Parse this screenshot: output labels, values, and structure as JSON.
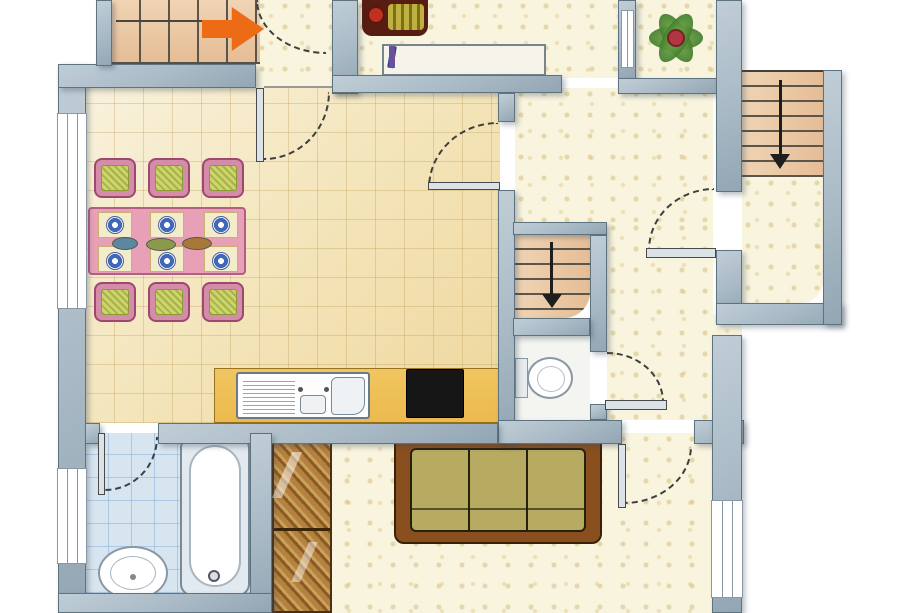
{
  "document": {
    "type": "floor-plan",
    "title": "apartment-floor-plan",
    "visible_text": ""
  },
  "colors": {
    "wall": "#a9bac6",
    "wall_hi": "#c0cdd6",
    "wall_edge": "#5d7380",
    "tile_a": "#f8f1dc",
    "tile_b": "#eed79c",
    "tile_line": "rgba(187,150,80,0.32)",
    "speckle_bg": "#f8f4de",
    "bath": "#d7e5f0",
    "wc": "#f4f5f1",
    "tread": "#e7c29c",
    "tread_line": "#5a564c",
    "arrow_up": "#ed6b15",
    "arrow_down": "#1e1e1e",
    "counter": "#ecba4e",
    "counter_edge": "#9a7320",
    "stove": "#161616",
    "table": "#e8a0b6",
    "table_edge": "#b25f84",
    "chair_frame": "#d58ca9",
    "chair_edge": "#9c4870",
    "chair_seat": "#ccd46a",
    "chair_seat_edge": "#8a9a34",
    "mat": "#f3ecca",
    "plate": "#3f68b8",
    "dish_teal": "#5b87a0",
    "dish_olive": "#8a9a4a",
    "dish_brown": "#a87838",
    "sofa_frame": "#8a4f1e",
    "sofa_edge": "#3a2008",
    "sofa_seat": "#b7ab61",
    "wardrobe_a": "#b5813f",
    "wardrobe_b": "#8a5a24",
    "wardrobe_c": "#caa05a",
    "wardrobe_edge": "#4a3010",
    "fixture": "#ffffff",
    "fixture_edge": "#8a98a5",
    "door_arc": "#3f3f3f",
    "door_leaf": "#dce3e8",
    "door_leaf_edge": "#4a4a4a",
    "bookshelf_bg": "#f6f4ea",
    "bookshelf_edge": "#77858c",
    "plant_green": "#3e7a2a",
    "plant_light": "#7ab24e",
    "plant_flower": "#b23642",
    "decor_base": "#571c12",
    "decor_stripe": "#c0b040",
    "decor_red": "#c03020",
    "window": "#ffffff",
    "window_edge": "#8a98a5"
  },
  "rooms": [
    {
      "name": "entry-hall",
      "floor": "speckled"
    },
    {
      "name": "dining-kitchen",
      "floor": "tiled"
    },
    {
      "name": "hallway",
      "floor": "speckled"
    },
    {
      "name": "bookshelf-alcove",
      "floor": "speckled"
    },
    {
      "name": "plant-room",
      "floor": "speckled"
    },
    {
      "name": "stair-room-right",
      "floor": "speckled"
    },
    {
      "name": "living-room",
      "floor": "speckled"
    },
    {
      "name": "bathroom",
      "floor": "blue-tiled"
    },
    {
      "name": "wc",
      "floor": "white"
    }
  ],
  "stairs": [
    {
      "name": "stairs-top-left",
      "direction_symbol": "orange-arrow-right"
    },
    {
      "name": "stairs-middle",
      "direction_symbol": "black-arrow-down"
    },
    {
      "name": "stairs-top-right",
      "direction_symbol": "black-arrow-down"
    }
  ],
  "furniture": [
    "dining-table",
    "chair x6",
    "place-setting x6",
    "serving-dish x3",
    "bookshelf",
    "flower-decor",
    "potted-plant",
    "kitchen-counter",
    "double-sink",
    "stove",
    "sofa",
    "wardrobe",
    "bathtub",
    "washbasin",
    "toilet"
  ],
  "bookshelf": {
    "shelves": [
      [
        "#2a3f8f",
        "#e8e8e8",
        "#6a4f9a",
        "#2a3f8f",
        "#4a9ad0",
        "#e8e8e8"
      ],
      [
        "#3f7a3f",
        "#b5c94a",
        "#4a6fd0",
        "#8a5aa0",
        "#e8e8e8",
        "#3f7a3f"
      ],
      [
        "#2a3f8f",
        "#4a9ad0",
        "#2a3f8f",
        "#b5c94a",
        "#6a4f9a"
      ]
    ]
  },
  "symbols": {
    "door_swing_arcs": 7,
    "windows": 4,
    "up_arrows": 1,
    "down_arrows": 2
  }
}
